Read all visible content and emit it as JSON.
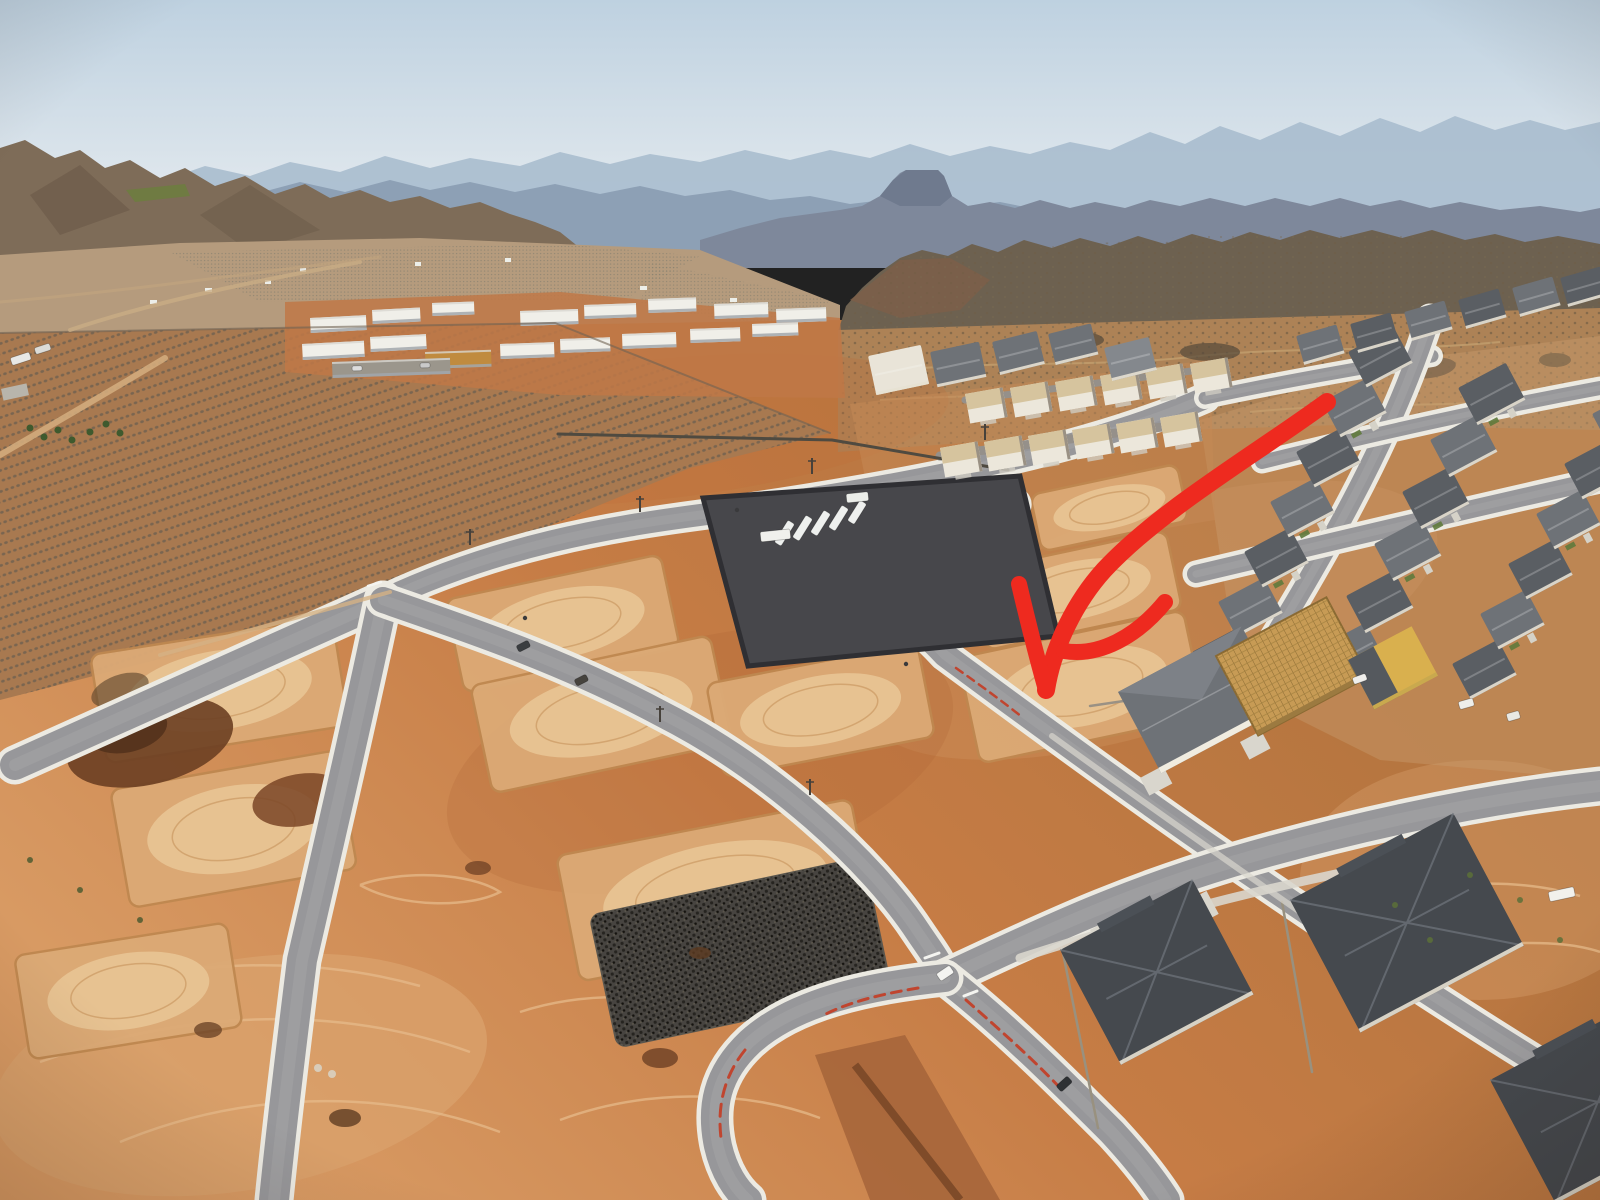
{
  "scene": {
    "type": "aerial-drone-photograph",
    "subject": "desert residential subdivision under construction with graded vacant lots, new roads, orchard, distant mesas and a hand-drawn red arrow pointing to one vacant lot",
    "annotation_present": true
  },
  "palette": {
    "sky_top": "#bed1e0",
    "sky_bot": "#eaeef1",
    "far": "#a9bdce",
    "mid": "#8da0b5",
    "mesa": "#7e889b",
    "butte": "#6f7a8e",
    "hills": "#7e6c58",
    "hills_dark": "#6a5947",
    "green_patch": "#6f7b42",
    "valley": "#b59b7d",
    "ridge": "#6d6150",
    "ridge_red": "#7d5f48",
    "scrub": "#ad8256",
    "pad": "#dcaa76",
    "pad_edge": "#bf8850",
    "pad_inner": "#e9c796",
    "road": "#97979a",
    "road_lt": "#ababad",
    "curb": "#eceae2",
    "red_curb": "#c0452f",
    "rv": "#47474b",
    "rv_wall": "#2f2f33",
    "roof_dark": "#45494e",
    "roof_dark2": "#5a5e63",
    "roof_mid": "#6e7277",
    "roof_light": "#84888d",
    "walls": "#e7e1d3",
    "wood": "#c79b55",
    "yellow": "#d9b04e",
    "arrow": "#ee2a1f",
    "concrete": "#d9d6cd",
    "track": "#e6ba8a",
    "orch": "#a87950",
    "orch_row": "#6a5f50",
    "green": "#5f7a3c",
    "white": "#f2f1ec"
  },
  "annotation": {
    "arrow": {
      "color": "$arrow",
      "style": "hand-drawn curved double-stroke",
      "points_at": "vacant graded lot in new subdivision",
      "shaft": "M1327,402 C1250,458 1160,510 1104,570 C1076,601 1053,646 1046,690",
      "barb_left": "M1019,584 C1027,618 1037,658 1046,690",
      "barb_right": "M1165,602 C1137,636 1100,657 1064,651",
      "shaft_width": 18,
      "barb_width": 16
    }
  },
  "layers": {
    "roads": [
      {
        "d": "M15,765 L383,600",
        "w": 30
      },
      {
        "d": "M383,600 C500,545 610,527 700,515 C830,497 1060,462 1205,398",
        "w": 22
      },
      {
        "d": "M1205,398 C1280,382 1360,368 1432,356",
        "w": 13
      },
      {
        "d": "M383,600 C362,700 332,830 302,960 C292,1040 282,1120 274,1200",
        "w": 30
      },
      {
        "d": "M383,600 C470,630 565,662 662,714 C772,770 872,862 918,932 C930,950 940,962 945,978",
        "w": 26
      },
      {
        "d": "M838,566 C888,600 920,628 945,655 C1002,697 1092,764 1192,834 C1302,910 1452,1012 1600,1100",
        "w": 24
      },
      {
        "d": "M945,978 C1032,938 1112,898 1232,862 C1342,830 1472,800 1600,786",
        "w": 30
      },
      {
        "d": "M945,978 C1002,1022 1062,1082 1112,1132 C1136,1158 1152,1178 1166,1200",
        "w": 28
      },
      {
        "d": "M945,978 C868,986 794,1002 750,1042 C716,1074 710,1108 718,1146 C724,1172 736,1190 748,1200",
        "w": 28
      },
      {
        "d": "M1238,696 C1322,560 1392,440 1430,318",
        "w": 20
      },
      {
        "d": "M1196,574 C1332,542 1472,508 1600,480",
        "w": 18
      },
      {
        "d": "M1262,462 C1382,432 1492,408 1600,388",
        "w": 14
      },
      {
        "d": "M870,564 C908,552 938,544 958,538 C990,528 1018,520 1021,506 C1023,494 1000,489 980,496 C962,503 951,514 955,526 C959,535 974,537 990,532",
        "w": 12
      },
      {
        "d": "M940,456 L1185,424",
        "w": 9,
        "curb": false,
        "c": "#95908a"
      },
      {
        "d": "M965,400 L1215,368",
        "w": 7,
        "curb": false,
        "c": "#95908a"
      }
    ],
    "accents": [
      {
        "d": "M918,988 C882,994 848,1002 822,1016",
        "c": "$red_curb",
        "w": 3,
        "dash": "10 7"
      },
      {
        "d": "M745,1050 C725,1075 717,1104 721,1138",
        "c": "$red_curb",
        "w": 3,
        "dash": "12 8"
      },
      {
        "d": "M966,1000 C1000,1030 1034,1060 1062,1090",
        "c": "$red_curb",
        "w": 3,
        "dash": "10 7"
      },
      {
        "d": "M956,668 C980,685 1002,701 1022,717",
        "c": "$red_curb",
        "w": 2.5,
        "dash": "8 6"
      },
      {
        "d": "M925,958 l14,-5",
        "c": "#f4f4f0",
        "w": 3
      },
      {
        "d": "M964,996 l13,-5",
        "c": "#f4f4f0",
        "w": 3
      },
      {
        "d": "M368,586 l13,-4",
        "c": "#f4f4f0",
        "w": 2.5
      },
      {
        "d": "M930,642 l12,-4",
        "c": "#f4f4f0",
        "w": 2.5
      },
      {
        "d": "M558,434 L832,440 L1008,470",
        "c": "#4f4a40",
        "w": 3
      },
      {
        "d": "M0,333 L555,323 L830,433",
        "c": "#6f6253",
        "w": 2,
        "o": 0.6
      },
      {
        "d": "M1062,948 L1098,1128",
        "c": "#99917f",
        "w": 2.5
      },
      {
        "d": "M1282,902 L1312,1072",
        "c": "#99917f",
        "w": 2.5
      },
      {
        "d": "M1090,706 L1266,680",
        "c": "#9a9184",
        "w": 2.5
      },
      {
        "d": "M1020,958 C1150,916 1300,878 1450,852",
        "c": "$concrete",
        "w": 9,
        "o": 0.9
      },
      {
        "d": "M1052,736 C1140,800 1260,884 1380,968",
        "c": "$concrete",
        "w": 6,
        "o": 0.7
      },
      {
        "d": "M70,330 C160,300 260,280 360,262",
        "c": "#c9ad85",
        "w": 4,
        "o": 0.8
      },
      {
        "d": "M0,302 C120,292 260,272 380,257",
        "c": "#c3a57e",
        "w": 3,
        "o": 0.6
      },
      {
        "d": "M0,455 C60,420 112,390 165,358",
        "c": "#d2ab7c",
        "w": 6,
        "o": 0.9
      },
      {
        "d": "M160,655 L390,592",
        "c": "#d4b285",
        "w": 4,
        "o": 0.8
      }
    ],
    "tracks": [
      {
        "d": "M60,1000 C160,962 300,952 420,986"
      },
      {
        "d": "M40,1062 C180,1012 330,1002 470,1052"
      },
      {
        "d": "M120,1142 C240,1092 380,1087 500,1132"
      },
      {
        "d": "M520,1012 C580,992 660,992 720,1012"
      },
      {
        "d": "M360,885 C400,870 470,872 500,892 C470,908 400,908 360,885"
      },
      {
        "d": "M560,1120 C640,1090 740,1088 820,1118"
      },
      {
        "d": "M1380,900 C1440,880 1520,878 1580,896"
      },
      {
        "d": "M1420,960 C1480,940 1560,938 1600,952"
      }
    ],
    "pads": [
      [
        90,
        655,
        245,
        110,
        -9
      ],
      [
        110,
        790,
        230,
        120,
        -10
      ],
      [
        14,
        956,
        215,
        105,
        -9
      ],
      [
        445,
        600,
        220,
        95,
        -12
      ],
      [
        470,
        686,
        245,
        110,
        -12
      ],
      [
        556,
        856,
        300,
        128,
        -11
      ],
      [
        706,
        684,
        215,
        95,
        -11
      ],
      [
        970,
        572,
        200,
        80,
        -12
      ],
      [
        958,
        658,
        230,
        108,
        -12
      ],
      [
        1030,
        495,
        150,
        58,
        -12
      ]
    ],
    "piles": [
      [
        150,
        742,
        85,
        42,
        -14,
        "#6b3f22",
        0.9
      ],
      [
        128,
        730,
        40,
        22,
        -14,
        "#53321c",
        0.9
      ],
      [
        300,
        800,
        48,
        26,
        -10,
        "#7a4526",
        0.85
      ],
      [
        208,
        1030,
        14,
        8,
        0,
        "#6d4528",
        0.8
      ],
      [
        345,
        1118,
        16,
        9,
        0,
        "#5e3c22",
        0.8
      ],
      [
        660,
        1058,
        18,
        10,
        0,
        "#6d4024",
        0.8
      ],
      [
        700,
        953,
        11,
        6,
        0,
        "#5e3c22",
        0.8
      ],
      [
        478,
        868,
        13,
        7,
        0,
        "#6d4024",
        0.75
      ],
      [
        120,
        690,
        30,
        15,
        -20,
        "#58432c",
        0.6
      ]
    ],
    "condos": [
      [
        310,
        318,
        56,
        15,
        -3
      ],
      [
        372,
        310,
        48,
        14,
        -3
      ],
      [
        432,
        303,
        42,
        13,
        -2
      ],
      [
        302,
        344,
        62,
        16,
        -3
      ],
      [
        370,
        337,
        56,
        15,
        -3
      ],
      [
        520,
        311,
        58,
        15,
        -2
      ],
      [
        584,
        305,
        52,
        14,
        -2
      ],
      [
        648,
        299,
        48,
        14,
        -2
      ],
      [
        714,
        304,
        54,
        15,
        -2
      ],
      [
        776,
        309,
        50,
        14,
        -2
      ],
      [
        500,
        344,
        54,
        15,
        -2
      ],
      [
        560,
        339,
        50,
        14,
        -2
      ],
      [
        622,
        334,
        54,
        15,
        -2
      ],
      [
        690,
        329,
        50,
        14,
        -2
      ],
      [
        752,
        324,
        46,
        13,
        -2
      ],
      [
        425,
        352,
        66,
        17,
        -2,
        "#c08b3f"
      ],
      [
        332,
        362,
        118,
        16,
        -2,
        "#9b968c"
      ]
    ],
    "townhomes": [
      [
        965,
        394
      ],
      [
        1010,
        388
      ],
      [
        1055,
        382
      ],
      [
        1100,
        376
      ],
      [
        1145,
        370
      ],
      [
        1190,
        364
      ],
      [
        940,
        448
      ],
      [
        984,
        442
      ],
      [
        1028,
        436
      ],
      [
        1072,
        430
      ],
      [
        1116,
        424
      ],
      [
        1160,
        418
      ]
    ],
    "houses": [
      [
        992,
        342,
        46,
        34,
        -14,
        "$roof_mid",
        0
      ],
      [
        1048,
        334,
        44,
        32,
        -14,
        "$roof_mid",
        0
      ],
      [
        1104,
        348,
        46,
        34,
        -14,
        "$roof_light",
        0
      ],
      [
        930,
        352,
        50,
        36,
        -12,
        "$roof_mid",
        0
      ],
      [
        868,
        356,
        54,
        40,
        -12,
        "#e9e4d8",
        0
      ],
      [
        1192,
        652,
        52,
        40,
        -28,
        "$roof_dark2",
        1
      ],
      [
        1218,
        602,
        52,
        40,
        -28,
        "$roof_mid",
        0
      ],
      [
        1244,
        552,
        52,
        40,
        -28,
        "$roof_dark2",
        1
      ],
      [
        1270,
        502,
        52,
        40,
        -28,
        "$roof_mid",
        1
      ],
      [
        1296,
        452,
        52,
        40,
        -28,
        "$roof_dark2",
        0
      ],
      [
        1322,
        402,
        52,
        40,
        -28,
        "$roof_mid",
        1
      ],
      [
        1348,
        352,
        52,
        40,
        -28,
        "$roof_dark2",
        0
      ],
      [
        1318,
        648,
        54,
        42,
        -28,
        "$roof_mid",
        1
      ],
      [
        1346,
        596,
        54,
        42,
        -28,
        "$roof_dark2",
        0
      ],
      [
        1374,
        544,
        54,
        42,
        -28,
        "$roof_mid",
        1
      ],
      [
        1402,
        492,
        54,
        42,
        -28,
        "$roof_dark2",
        1
      ],
      [
        1430,
        440,
        54,
        42,
        -28,
        "$roof_mid",
        0
      ],
      [
        1458,
        388,
        54,
        42,
        -28,
        "$roof_dark2",
        1
      ],
      [
        1452,
        664,
        52,
        40,
        -28,
        "$roof_dark2",
        0
      ],
      [
        1480,
        614,
        52,
        40,
        -28,
        "$roof_mid",
        1
      ],
      [
        1508,
        564,
        52,
        40,
        -28,
        "$roof_dark2",
        0
      ],
      [
        1536,
        514,
        52,
        40,
        -28,
        "$roof_mid",
        1
      ],
      [
        1564,
        464,
        52,
        40,
        -28,
        "$roof_dark2",
        0
      ],
      [
        1592,
        414,
        52,
        40,
        -28,
        "$roof_mid",
        0
      ],
      [
        1296,
        336,
        42,
        30,
        -16,
        "$roof_mid",
        0
      ],
      [
        1350,
        324,
        42,
        30,
        -16,
        "$roof_dark2",
        0
      ],
      [
        1404,
        312,
        42,
        30,
        -16,
        "$roof_mid",
        0
      ],
      [
        1458,
        300,
        42,
        30,
        -16,
        "$roof_dark2",
        0
      ],
      [
        1512,
        288,
        42,
        30,
        -16,
        "$roof_mid",
        0
      ],
      [
        1560,
        278,
        42,
        30,
        -16,
        "$roof_dark2",
        0
      ]
    ],
    "big_houses": [
      [
        1060,
        950,
        150,
        130,
        -28,
        ""
      ],
      [
        1290,
        900,
        185,
        150,
        -28,
        ""
      ],
      [
        1490,
        1080,
        170,
        140,
        -28,
        ""
      ],
      [
        1118,
        692,
        140,
        92,
        -28,
        "white"
      ],
      [
        1216,
        656,
        125,
        90,
        -28,
        "frame"
      ],
      [
        1348,
        660,
        72,
        56,
        -28,
        "yellow"
      ]
    ],
    "drives": [
      [
        1090,
        930,
        30,
        26,
        -28
      ],
      [
        1180,
        905,
        30,
        26,
        -28
      ],
      [
        1340,
        872,
        34,
        28,
        -28
      ],
      [
        1140,
        778,
        26,
        20,
        -28
      ],
      [
        1240,
        742,
        24,
        20,
        -28
      ]
    ],
    "vehicles": [
      [
        936,
        974,
        16,
        9,
        -34,
        "#f4f4f1"
      ],
      [
        1056,
        1086,
        15,
        8,
        -42,
        "#2e3134"
      ],
      [
        516,
        646,
        13,
        7,
        -27,
        "#3a3d40"
      ],
      [
        574,
        680,
        13,
        7,
        -27,
        "#46433e"
      ],
      [
        1458,
        702,
        15,
        8,
        -16,
        "#eeeeea"
      ],
      [
        1506,
        714,
        13,
        8,
        -16,
        "#e9e9e4"
      ],
      [
        1352,
        678,
        14,
        7,
        -20,
        "#f0efec"
      ],
      [
        1548,
        892,
        26,
        10,
        -12,
        "#f2f1ec"
      ],
      [
        10,
        358,
        20,
        8,
        -18,
        "#e8e8e6"
      ],
      [
        34,
        348,
        16,
        7,
        -18,
        "#dcdcd8"
      ],
      [
        352,
        366,
        10,
        5,
        -2,
        "#dddddd"
      ],
      [
        420,
        363,
        10,
        5,
        -2,
        "#c9c9c9"
      ],
      [
        788,
        520,
        8,
        26,
        32,
        "#eef0ee"
      ],
      [
        806,
        515,
        8,
        26,
        32,
        "#eef0ee"
      ],
      [
        824,
        510,
        8,
        26,
        32,
        "#eef0ee"
      ],
      [
        842,
        505,
        8,
        26,
        32,
        "#eef0ee"
      ],
      [
        860,
        500,
        8,
        24,
        32,
        "#eef0ee"
      ],
      [
        760,
        532,
        30,
        10,
        -6,
        "#f0f0ec"
      ],
      [
        846,
        494,
        22,
        9,
        -6,
        "#eceeea"
      ]
    ],
    "people": [
      [
        525,
        618
      ],
      [
        737,
        510
      ],
      [
        906,
        664
      ]
    ],
    "poles": [
      [
        470,
        545
      ],
      [
        640,
        512
      ],
      [
        812,
        474
      ],
      [
        985,
        440
      ],
      [
        660,
        722
      ],
      [
        810,
        795
      ]
    ],
    "shrubs": [
      [
        1395,
        905,
        3,
        "#5c7038"
      ],
      [
        1430,
        940,
        3,
        "#5c7038"
      ],
      [
        1520,
        900,
        3,
        "#5c7038"
      ],
      [
        1560,
        940,
        3,
        "#5c7038"
      ],
      [
        1470,
        875,
        3,
        "#5c7038"
      ],
      [
        30,
        860,
        3,
        "#4e5a30"
      ],
      [
        80,
        890,
        3,
        "#4e5a30"
      ],
      [
        140,
        920,
        3,
        "#4e5a30"
      ],
      [
        318,
        1068,
        4,
        "#d8d4c8"
      ],
      [
        332,
        1074,
        4,
        "#d8d4c8"
      ]
    ]
  }
}
